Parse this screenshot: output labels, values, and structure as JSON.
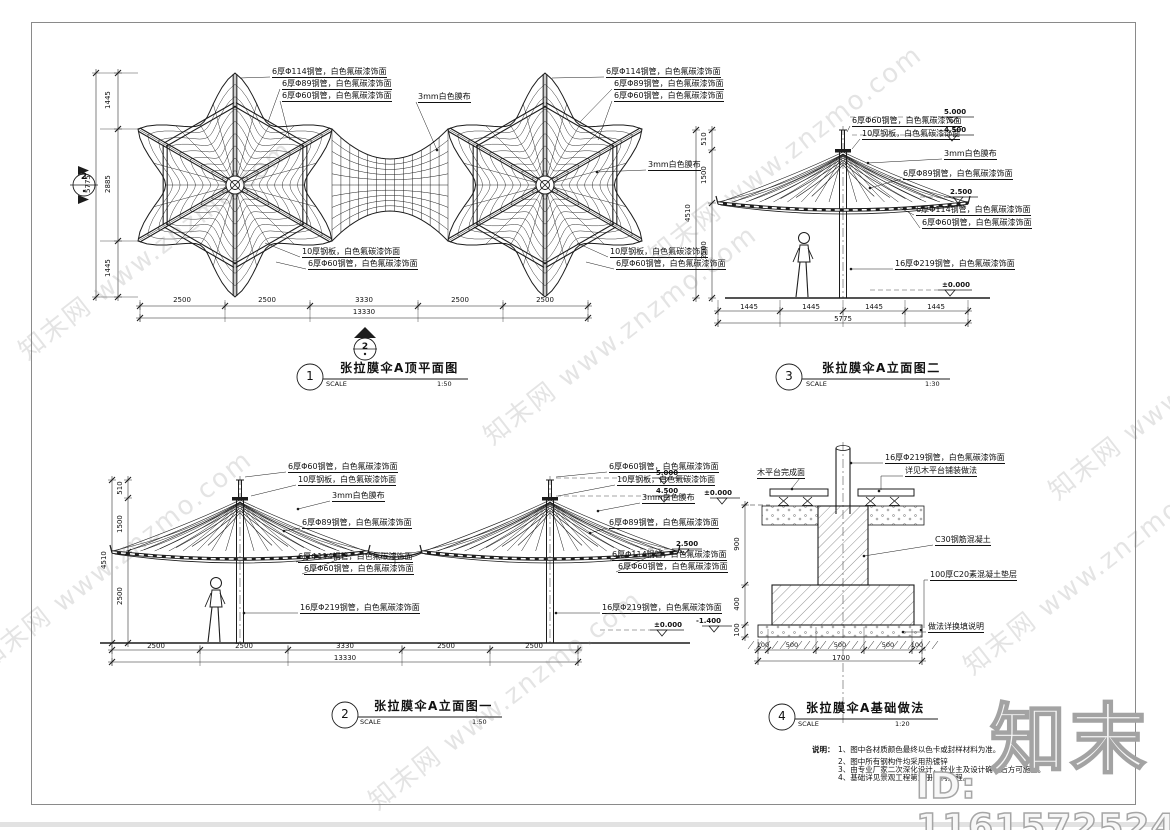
{
  "watermark": {
    "tile": "知末网 www.znzmo.com",
    "brand": "知末",
    "id": "ID: 1161572524"
  },
  "materials": {
    "p114": "6厚Φ114钢管，白色氟碳漆饰面",
    "p89": "6厚Φ89钢管，白色氟碳漆饰面",
    "p60": "6厚Φ60钢管，白色氟碳漆饰面",
    "plate10": "10厚钢板，白色氟碳漆饰面",
    "p219": "16厚Φ219钢管，白色氟碳漆饰面",
    "membrane": "3mm白色膜布"
  },
  "plan": {
    "bubble_no": "1",
    "title": "张拉膜伞A顶平面图",
    "scale_label": "SCALE",
    "scale": "1:50",
    "section_no": "2",
    "dims_h": [
      "2500",
      "2500",
      "3330",
      "2500",
      "2500"
    ],
    "dims_h_total": "13330",
    "dims_v": [
      "1445",
      "2885",
      "1445"
    ],
    "dims_v_total": "5775"
  },
  "elev_front": {
    "bubble_no": "2",
    "title": "张拉膜伞A立面图一",
    "scale_label": "SCALE",
    "scale": "1:50",
    "dims_h": [
      "2500",
      "2500",
      "3330",
      "2500",
      "2500"
    ],
    "dims_h_total": "13330",
    "dims_v": [
      "510",
      "1500",
      "2500"
    ],
    "dims_v_total": "4510",
    "levels": {
      "top": "5.000",
      "plate": "4.500",
      "edge": "2.500",
      "ground": "±0.000"
    }
  },
  "elev_side": {
    "bubble_no": "3",
    "title": "张拉膜伞A立面图二",
    "scale_label": "SCALE",
    "scale": "1:30",
    "dims_h": [
      "1445",
      "1445",
      "1445",
      "1445"
    ],
    "dims_h_total": "5775",
    "dims_v": [
      "510",
      "1500",
      "2500"
    ],
    "dims_v_total": "4510",
    "levels": {
      "top": "5.000",
      "plate": "4.500",
      "edge": "2.500",
      "ground": "±0.000"
    }
  },
  "foundation": {
    "bubble_no": "4",
    "title": "张拉膜伞A基础做法",
    "scale_label": "SCALE",
    "scale": "1:20",
    "labels": {
      "deck_finish": "木平台完成面",
      "paving_ref": "详见木平台铺装做法",
      "concrete": "C30钢筋混凝土",
      "cushion": "100厚C20素混凝土垫层",
      "backfill": "做法详换填说明"
    },
    "levels": {
      "ground": "±0.000",
      "bottom": "-1.400"
    },
    "dims_v": [
      "900",
      "400",
      "100"
    ],
    "dims_h": [
      "100",
      "500",
      "500",
      "500",
      "100"
    ],
    "dims_h_total": "1700"
  },
  "notes": {
    "heading": "说明：",
    "items": [
      "1、图中各材质颜色最终以色卡或封样材料为准。",
      "2、图中所有钢构件均采用热镀锌",
      "3、由专业厂家二次深化设计，经业主及设计确认后方可施工。",
      "4、基础详见景观工程第六册结构工程。"
    ]
  }
}
